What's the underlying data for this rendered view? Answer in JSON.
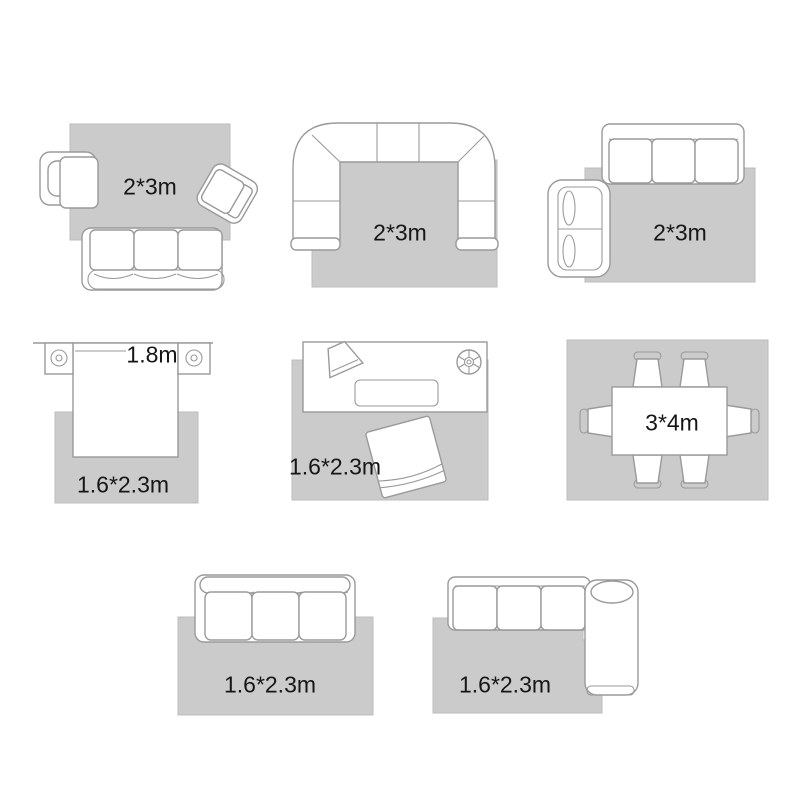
{
  "colors": {
    "rug": "#cbcbcb",
    "outline": "#9a9a9a",
    "label": "#161616",
    "background": "#ffffff"
  },
  "layouts": [
    {
      "name": "sofa-with-two-armchairs",
      "rug_label": "2*3m"
    },
    {
      "name": "u-shaped-sectional-sofa",
      "rug_label": "2*3m"
    },
    {
      "name": "sofa-with-loveseat",
      "rug_label": "2*3m"
    },
    {
      "name": "bed-with-nightstands",
      "rug_label": "1.6*2.3m",
      "bed_width_label": "1.8m"
    },
    {
      "name": "console-with-floor-cushion",
      "rug_label": "1.6*2.3m"
    },
    {
      "name": "dining-table-six-chairs",
      "rug_label": "3*4m"
    },
    {
      "name": "three-seat-sofa",
      "rug_label": "1.6*2.3m"
    },
    {
      "name": "chaise-sectional-sofa",
      "rug_label": "1.6*2.3m"
    }
  ]
}
